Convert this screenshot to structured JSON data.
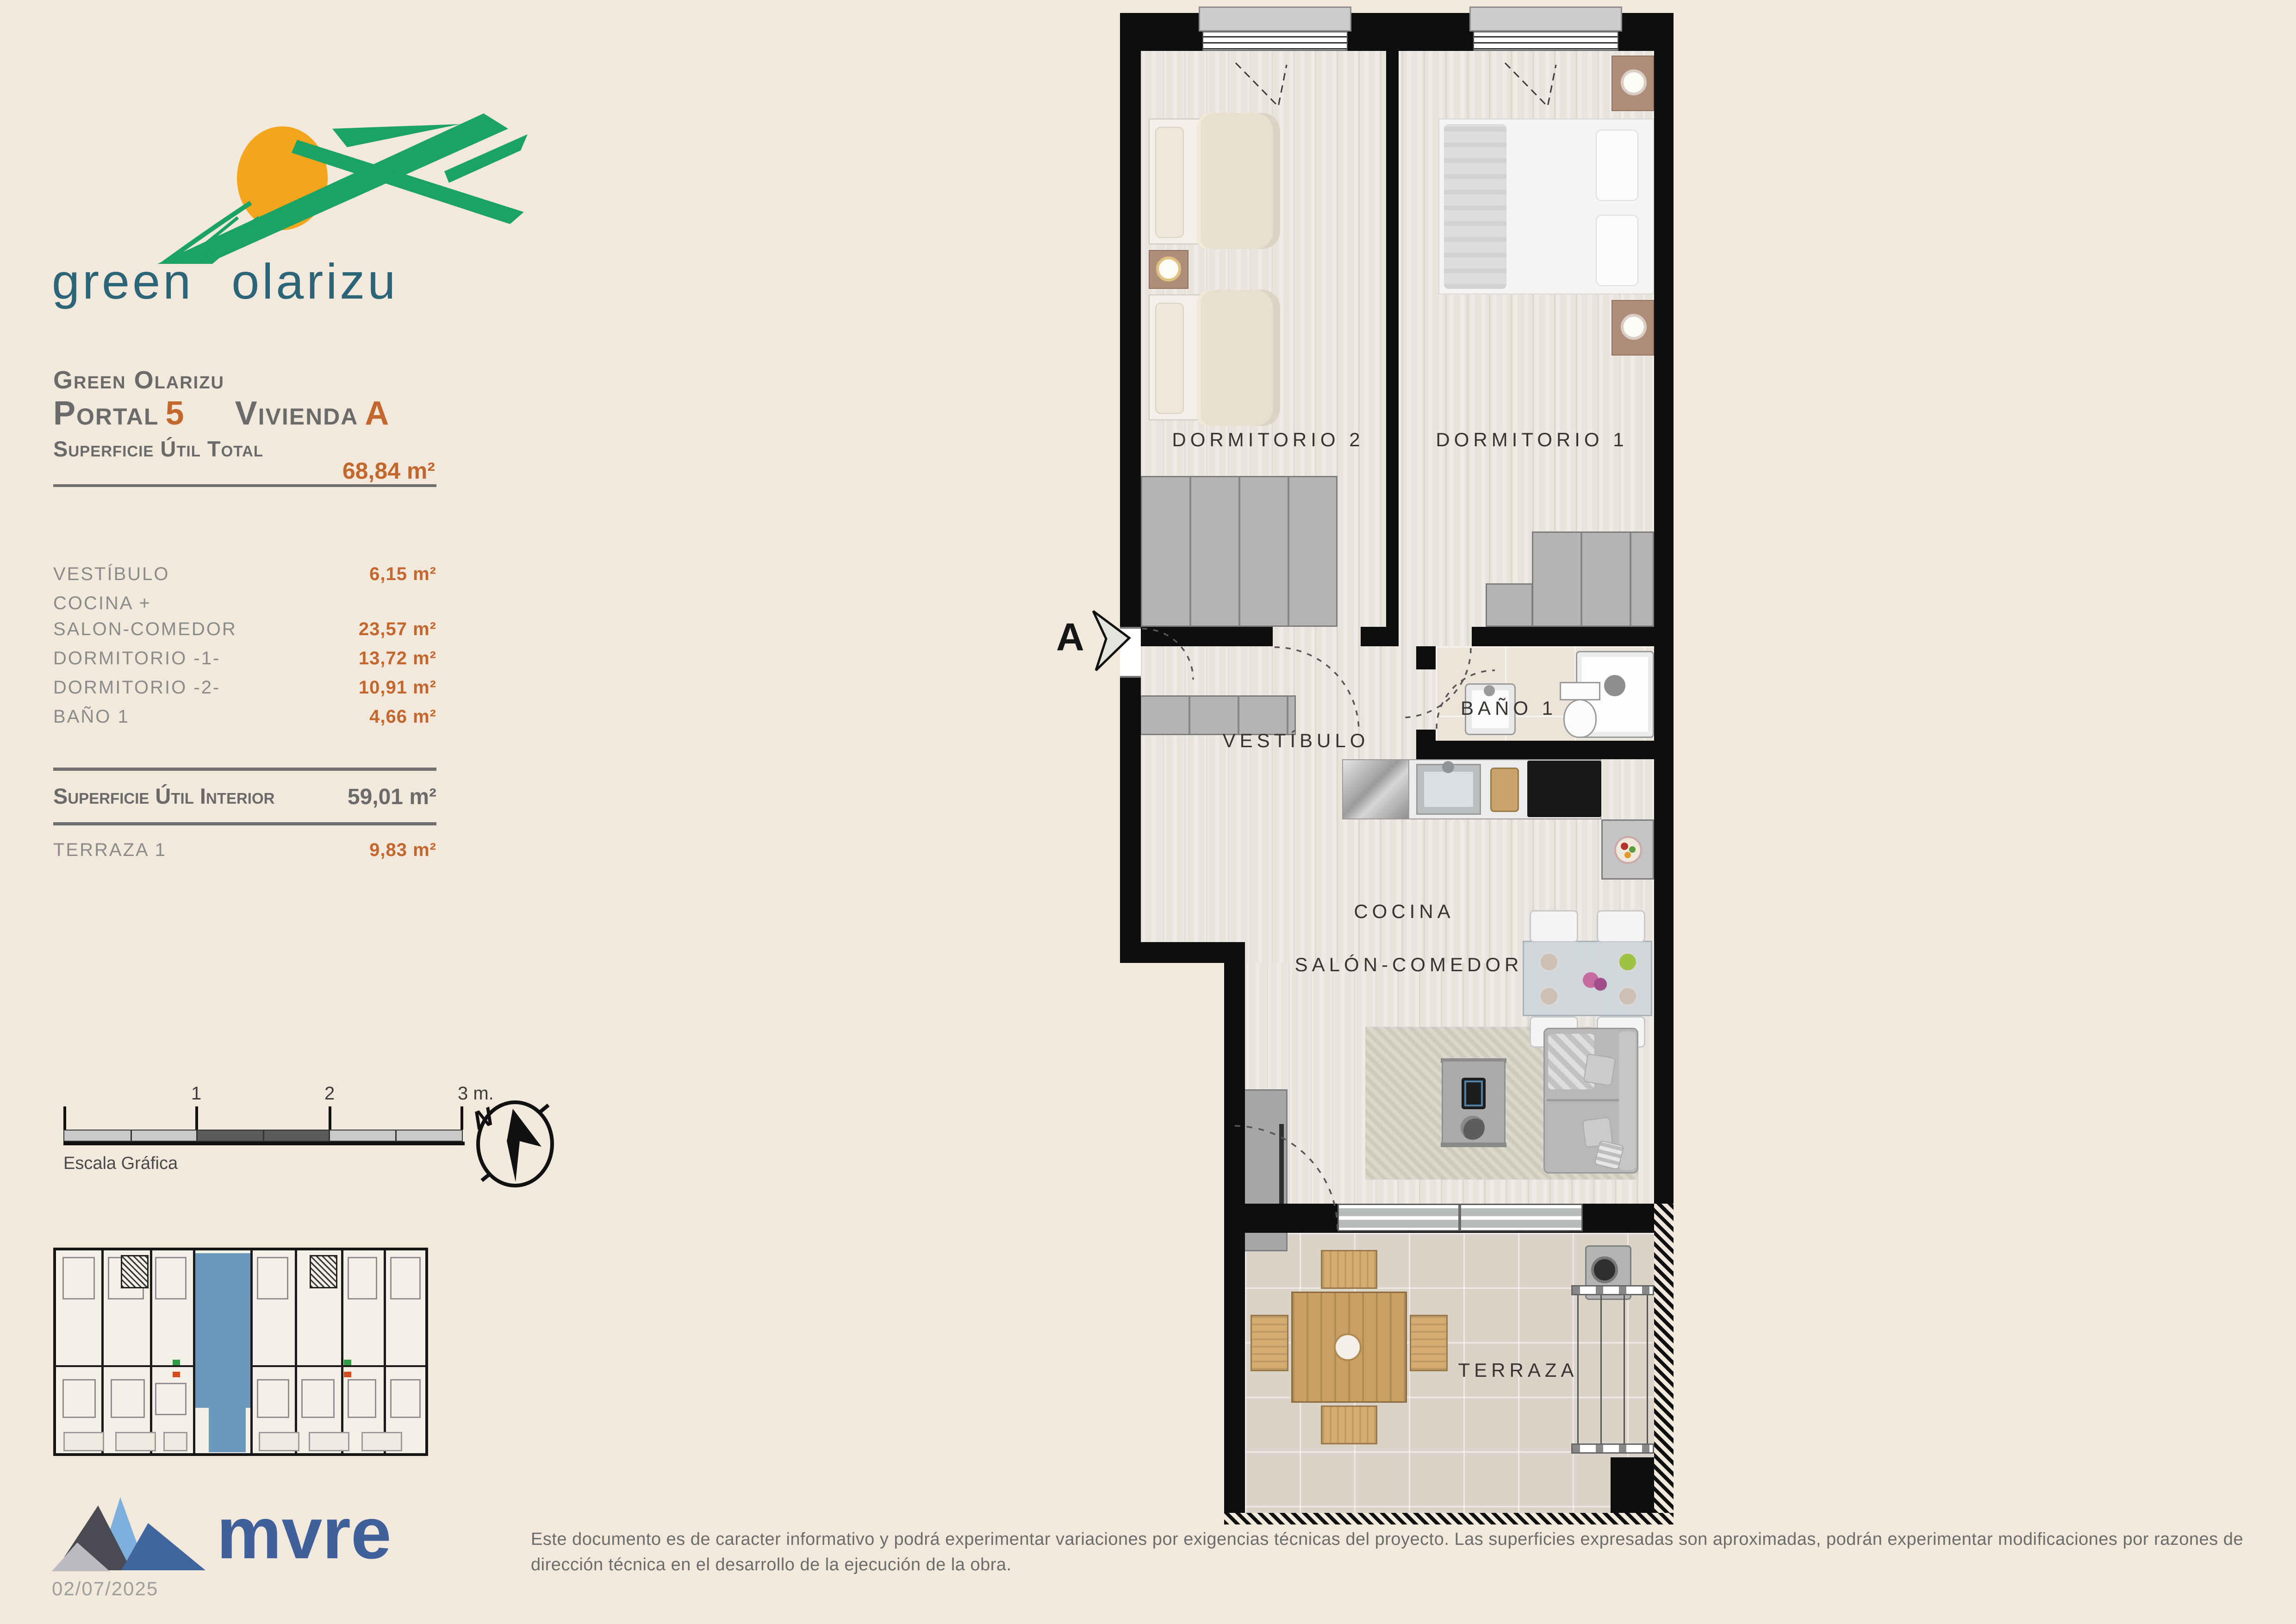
{
  "logo": {
    "text": "green olarizu"
  },
  "panel": {
    "project": "Green Olarizu",
    "portal_label": "Portal",
    "portal_number": "5",
    "vivienda_label": "Vivienda",
    "vivienda_letter": "A",
    "total_label": "Superficie Útil Total",
    "total_value": "68,84 m²",
    "rows": [
      {
        "label": "VESTÍBULO",
        "value": "6,15 m²"
      },
      {
        "label": "COCINA +",
        "value": ""
      },
      {
        "label": "SALON-COMEDOR",
        "value": "23,57 m²"
      },
      {
        "label": "DORMITORIO -1-",
        "value": "13,72 m²"
      },
      {
        "label": "DORMITORIO -2-",
        "value": "10,91 m²"
      },
      {
        "label": "BAÑO 1",
        "value": "4,66 m²"
      }
    ],
    "interior_label": "Superficie Útil Interior",
    "interior_value": "59,01 m²",
    "terrace_label": "TERRAZA 1",
    "terrace_value": "9,83 m²"
  },
  "scalebar": {
    "tick1": "1",
    "tick2": "2",
    "tick3": "3 m.",
    "caption": "Escala Gráfica"
  },
  "compass": {
    "letter": "N"
  },
  "plan": {
    "section_marker": "A",
    "rooms": {
      "dorm2": "DORMITORIO 2",
      "dorm1": "DORMITORIO 1",
      "vestibulo": "VESTÍBULO",
      "bano": "BAÑO 1",
      "cocina": "COCINA",
      "salon": "SALÓN-COMEDOR",
      "terraza": "TERRAZA"
    }
  },
  "footer": {
    "disclaimer": "Este documento es de caracter informativo y podrá experimentar variaciones por exigencias técnicas del proyecto. Las superficies expresadas son aproximadas, podrán experimentar modificaciones por razones de dirección técnica en el desarrollo de la ejecución de la obra.",
    "brand": "mvre",
    "date": "02/07/2025"
  },
  "colors": {
    "accent_orange": "#c2672d",
    "text_gray": "#6b6b6b",
    "wall_black": "#0e0e0e",
    "highlight_blue": "#6c98bb",
    "brand_blue": "#40609b",
    "logo_green": "#1ba365",
    "logo_teal": "#2b6577",
    "logo_sun": "#f3a61c",
    "page_background": "#f2e9dc"
  }
}
